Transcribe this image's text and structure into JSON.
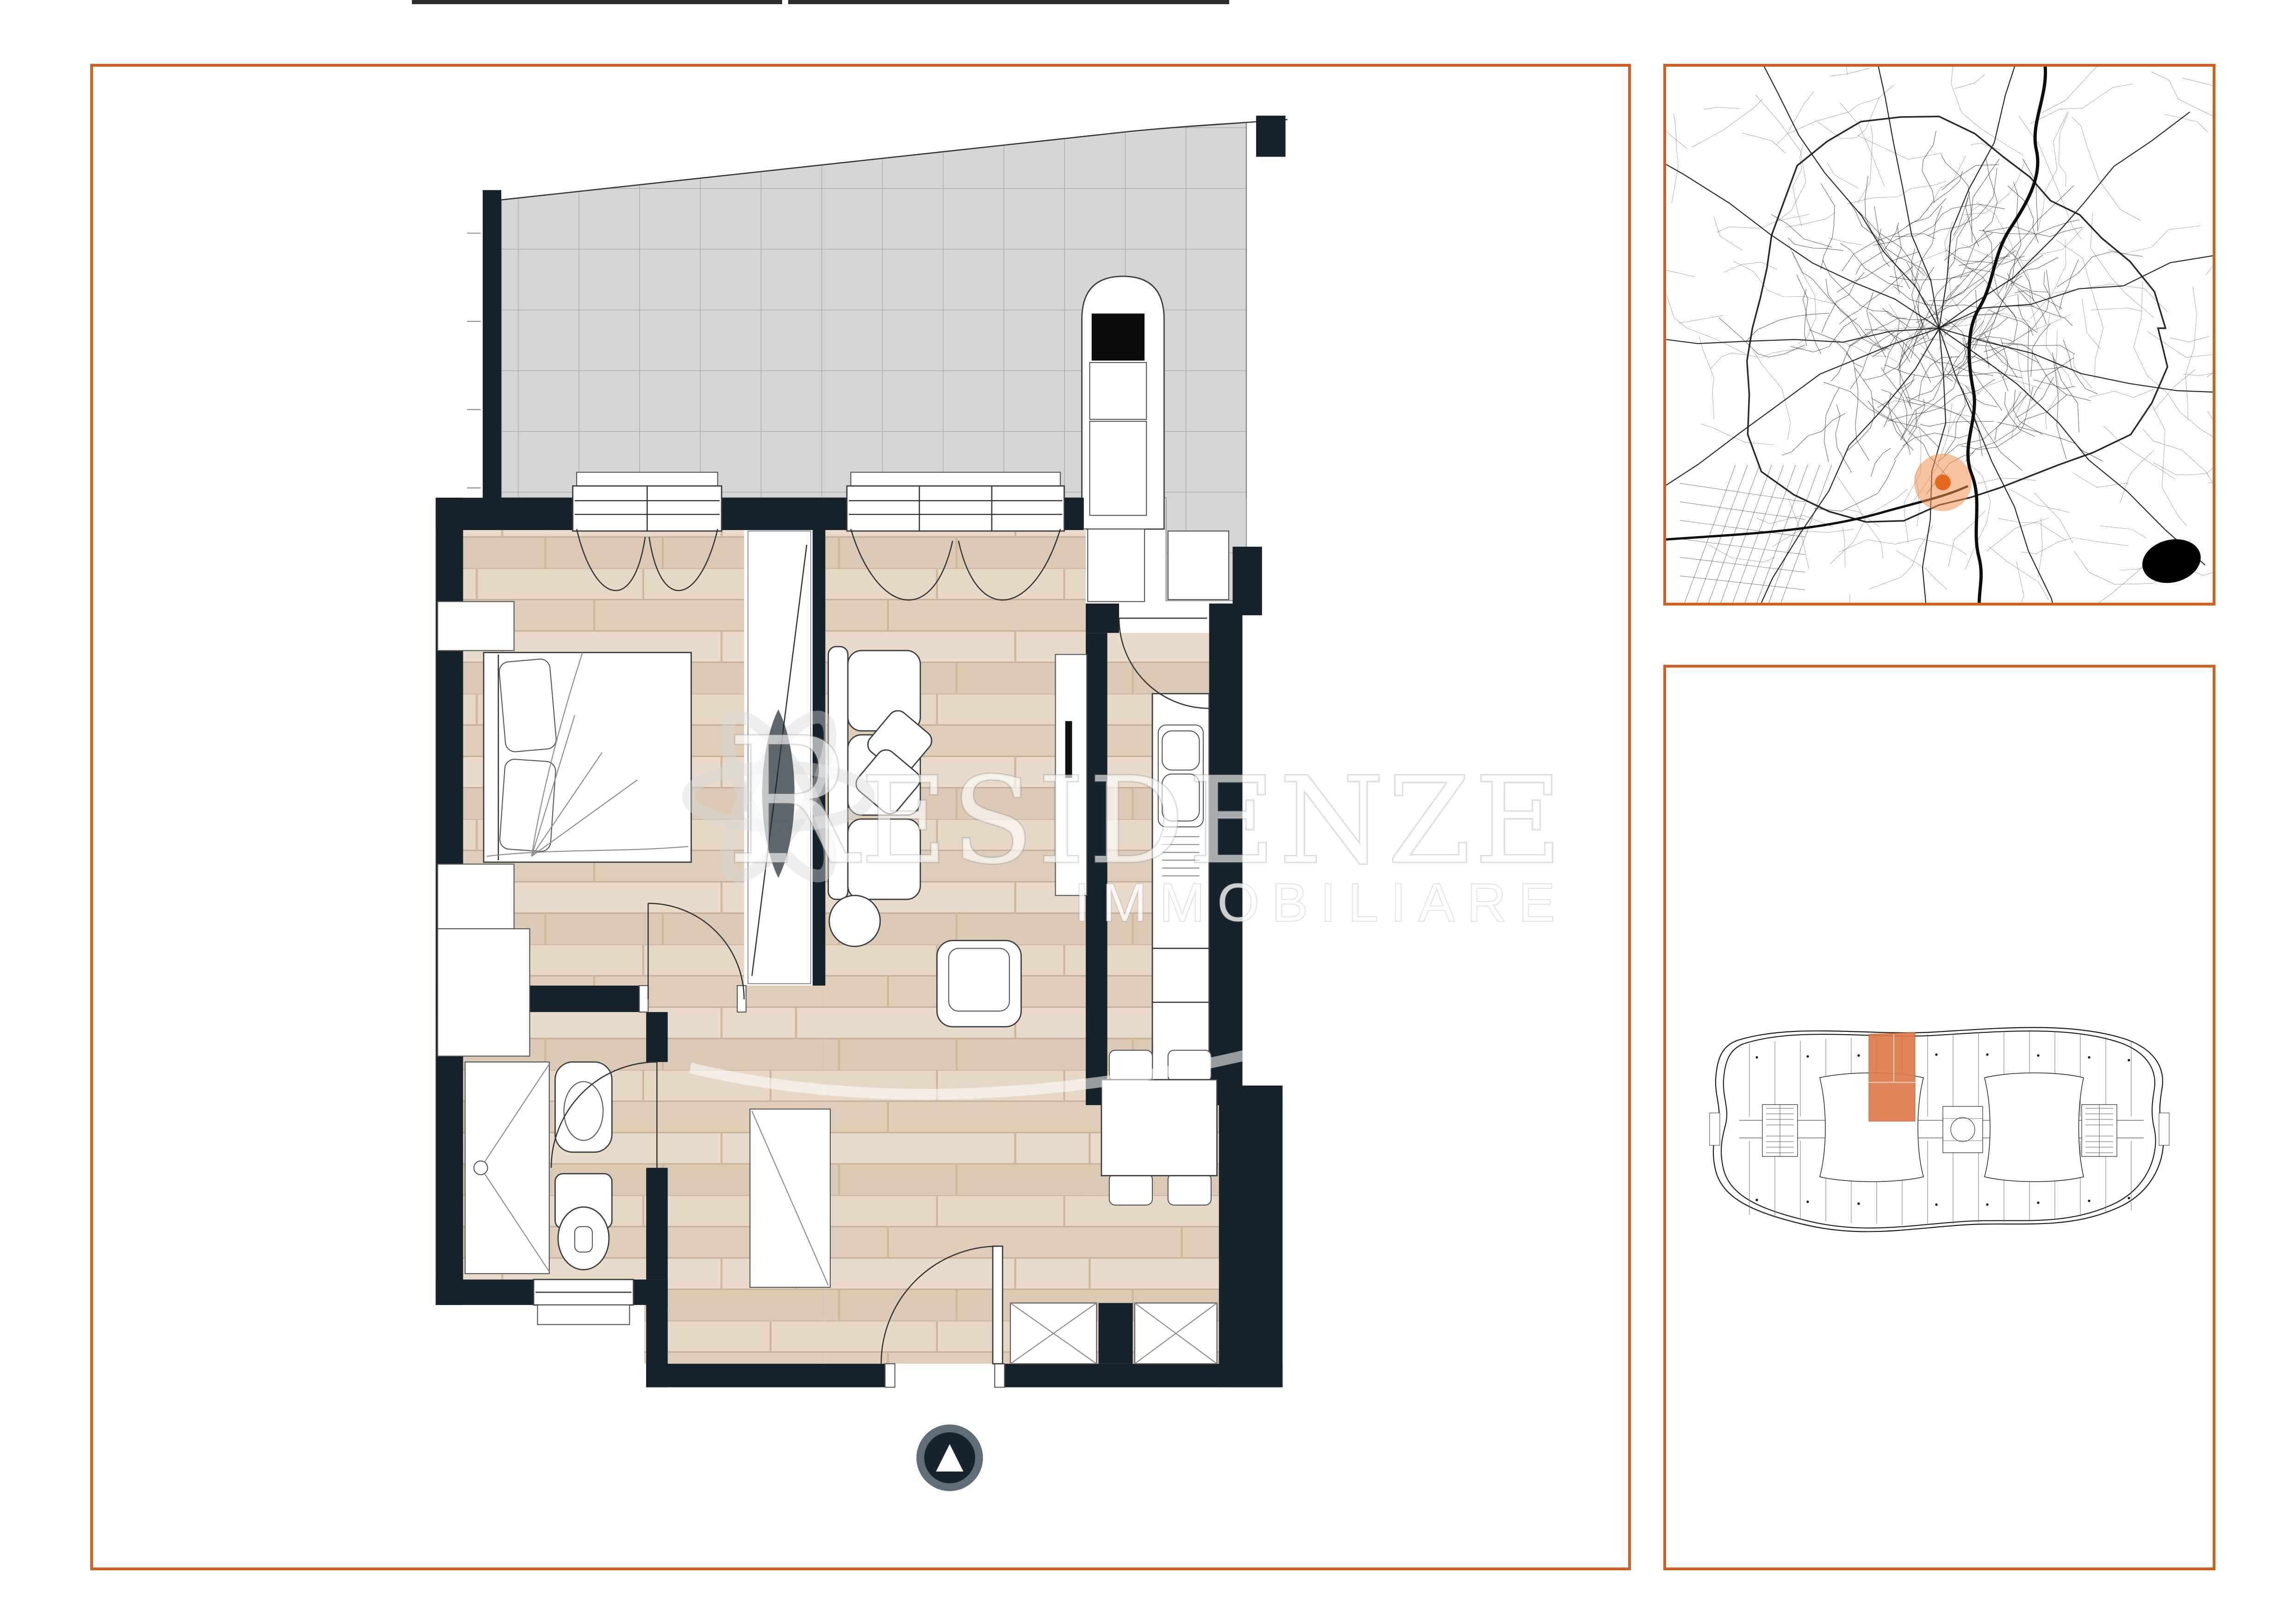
{
  "watermark": {
    "title": "RESIDENZE",
    "subtitle": "IMMOBILIARE"
  },
  "entrance_marker": {
    "symbol": "▲"
  },
  "colors": {
    "accent": "#d1601d",
    "wall": "#15222c",
    "terrace_tile": "#d5d5d5",
    "floor_wood": "#e4d3c0",
    "map_marker": "#e4681c",
    "map_marker_halo": "#f0924f",
    "highlight_unit": "#dc7a48"
  }
}
